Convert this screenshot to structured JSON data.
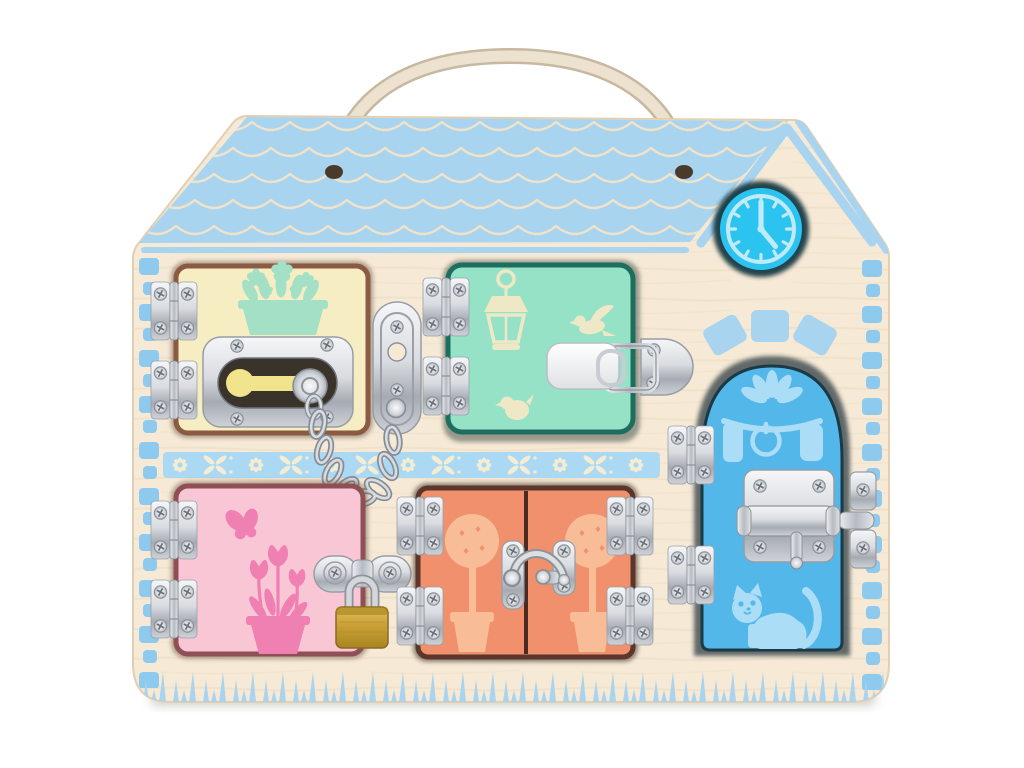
{
  "scene": {
    "type": "product-photo",
    "subject": "Wooden house-shaped latches busy board toy with five colored doors, metal locks, rope carry handle, clock graphic, photographed on a plain white background"
  },
  "colors": {
    "background": "#ffffff",
    "wood": "#f6e9d6",
    "wood_edge": "#e2cfb2",
    "wood_grain": "#ead9bd",
    "shadow": "#b3aa9e",
    "roof_blue": "#a9d4f0",
    "shingle_line": "#f2e3c8",
    "quoin_blue": "#8ecaee",
    "band_blue": "#abd8f2",
    "band_flower": "#f4edd3",
    "grass_blue": "#a5d2ef",
    "clock_face": "#2bc3ef",
    "clock_ring": "#bfeaf9",
    "clock_recess": "#10303d",
    "rope": "#ece2cf",
    "rope_shadow": "#c7b9a1",
    "hole_dark": "#4a3a29",
    "metal_light": "#f2f3f5",
    "metal_dark": "#8f959d",
    "brass": "#c9a23c"
  },
  "roof": {
    "pattern": "rows of scalloped shingles",
    "gable": "chevron outline over clock tower",
    "arch_bricks": 3
  },
  "clock": {
    "minute_hand_at": "12",
    "hour_hand_at": "between 4 and 5",
    "tick_count": 12
  },
  "handle": {
    "type": "rope loop through two roof holes"
  },
  "doors": [
    {
      "id": "top-left",
      "name": "yellow door",
      "color": "#f7edc3",
      "border_color": "#8a5a42",
      "print": "window box with daisies",
      "print_color": "#a3e0c6",
      "lock": "slide-track chain lock with keyhole plate",
      "hinges": 2
    },
    {
      "id": "top-right",
      "name": "mint door",
      "color": "#96e2c6",
      "border_color": "#1e6e60",
      "print": "lantern, flying bird, chick",
      "print_color": "#efe8c6",
      "lock": "suitcase draw latch",
      "hinges": 2
    },
    {
      "id": "bottom-left",
      "name": "pink door",
      "color": "#f9c6d6",
      "border_color": "#8e4f55",
      "print": "butterfly and tulip flower pot",
      "print_color": "#f07fb2",
      "lock": "hasp and staple with brass padlock",
      "hinges": 2
    },
    {
      "id": "bottom-center",
      "name": "orange double door",
      "color": "#f0906c",
      "border_color": "#5a362c",
      "print": "topiary tree in pot on each leaf",
      "print_color": "#f8bd97",
      "lock": "swing hook latch",
      "hinges": 4
    },
    {
      "id": "right",
      "name": "blue arched door",
      "color": "#53b8e9",
      "border_color": "#1c3a46",
      "print": "fanlight, knocker ring, panels, sitting cat",
      "print_color": "#abddf6",
      "lock": "barrel bolt with catch",
      "hinges": 2
    }
  ],
  "hardware": {
    "hinge_style": "silver butt hinge with four screws",
    "chain_links": 8,
    "padlock": "brass body with steel shackle"
  }
}
